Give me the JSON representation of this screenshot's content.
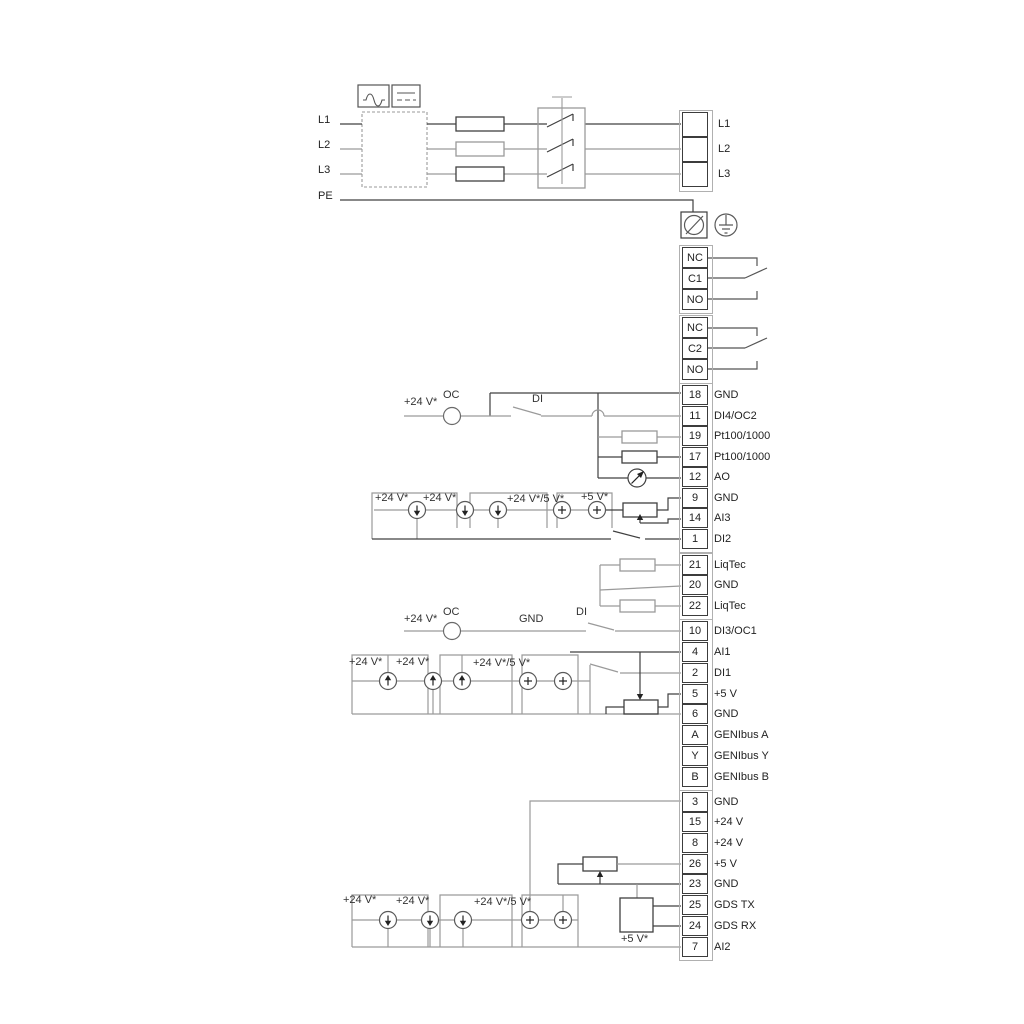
{
  "power": {
    "inputs": [
      {
        "label": "L1"
      },
      {
        "label": "L2"
      },
      {
        "label": "L3"
      },
      {
        "label": "PE"
      }
    ],
    "outputs": [
      {
        "label": "L1"
      },
      {
        "label": "L2"
      },
      {
        "label": "L3"
      }
    ]
  },
  "relays": {
    "r1": [
      {
        "label": "NC"
      },
      {
        "label": "C1"
      },
      {
        "label": "NO"
      }
    ],
    "r2": [
      {
        "label": "NC"
      },
      {
        "label": "C2"
      },
      {
        "label": "NO"
      }
    ]
  },
  "strips": {
    "a": [
      {
        "num": "18",
        "label": "GND"
      },
      {
        "num": "11",
        "label": "DI4/OC2"
      },
      {
        "num": "19",
        "label": "Pt100/1000"
      },
      {
        "num": "17",
        "label": "Pt100/1000"
      },
      {
        "num": "12",
        "label": "AO"
      },
      {
        "num": "9",
        "label": "GND"
      },
      {
        "num": "14",
        "label": "AI3"
      },
      {
        "num": "1",
        "label": "DI2"
      }
    ],
    "b": [
      {
        "num": "21",
        "label": "LiqTec"
      },
      {
        "num": "20",
        "label": "GND"
      },
      {
        "num": "22",
        "label": "LiqTec"
      }
    ],
    "c": [
      {
        "num": "10",
        "label": "DI3/OC1"
      },
      {
        "num": "4",
        "label": "AI1"
      },
      {
        "num": "2",
        "label": "DI1"
      },
      {
        "num": "5",
        "label": "+5 V"
      },
      {
        "num": "6",
        "label": "GND"
      },
      {
        "num": "A",
        "label": "GENIbus A"
      },
      {
        "num": "Y",
        "label": "GENIbus Y"
      },
      {
        "num": "B",
        "label": "GENIbus B"
      }
    ],
    "d": [
      {
        "num": "3",
        "label": "GND"
      },
      {
        "num": "15",
        "label": "+24 V"
      },
      {
        "num": "8",
        "label": "+24 V"
      },
      {
        "num": "26",
        "label": "+5 V"
      },
      {
        "num": "23",
        "label": "GND"
      },
      {
        "num": "25",
        "label": "GDS TX"
      },
      {
        "num": "24",
        "label": "GDS RX"
      },
      {
        "num": "7",
        "label": "AI2"
      }
    ]
  },
  "ann": {
    "di4_v24": "+24 V*",
    "di4_oc": "OC",
    "di4_di": "DI",
    "ai3_v24a": "+24 V*",
    "ai3_v24b": "+24 V*",
    "ai3_v245": "+24 V*/5 V*",
    "ai3_v5": "+5 V*",
    "di3_v24": "+24 V*",
    "di3_oc": "OC",
    "di3_gnd": "GND",
    "di3_di": "DI",
    "ai1_v24a": "+24 V*",
    "ai1_v24b": "+24 V*",
    "ai1_v245": "+24 V*/5 V*",
    "ai2_v24a": "+24 V*",
    "ai2_v24b": "+24 V*",
    "ai2_v245": "+24 V*/5 V*",
    "ai2_v5": "+5 V*"
  },
  "icons": {
    "converter_ac": "ac-wave-icon",
    "converter_dc": "dc-line-icon",
    "screw": "screw-terminal-icon",
    "earth": "protective-earth-icon",
    "source_down": "current-source-down-arrow-icon",
    "source_up": "current-source-up-arrow-icon",
    "source_plus": "plus-source-icon",
    "meter": "analog-output-meter-icon",
    "resistor": "resistor-icon",
    "potentiometer": "potentiometer-icon",
    "switch": "switch-contact-icon"
  },
  "colors": {
    "wire_gray": "#9a9a9a",
    "wire_dark": "#404040",
    "text": "#222222"
  }
}
